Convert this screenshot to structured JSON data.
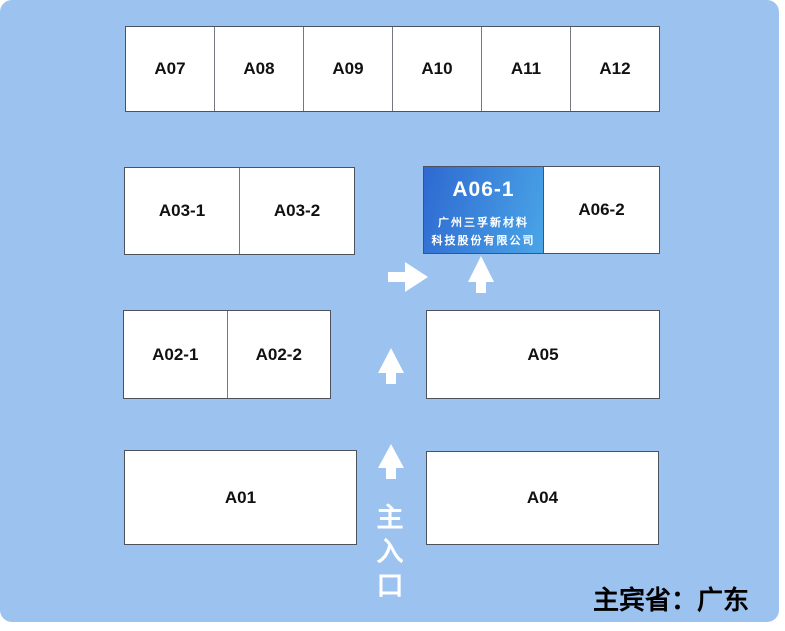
{
  "canvas": {
    "background_color": "#9CC2EF",
    "corner_radius_px": 12
  },
  "colors": {
    "booth_fill": "#FFFFFF",
    "booth_border": "#4D525C",
    "highlight_gradient_from": "#2E69D1",
    "highlight_gradient_to": "#4AA5E7",
    "label_text": "#111111",
    "arrow_and_entrance_text": "#FFFFFF",
    "footer_text": "#000000"
  },
  "booths": {
    "top_row": [
      "A07",
      "A08",
      "A09",
      "A10",
      "A11",
      "A12"
    ],
    "a03_row": [
      "A03-1",
      "A03-2"
    ],
    "a06_row": {
      "highlight": {
        "label": "A06-1",
        "company_line1": "广州三孚新材料",
        "company_line2": "科技股份有限公司"
      },
      "neighbor": "A06-2"
    },
    "a02_row": [
      "A02-1",
      "A02-2"
    ],
    "a05": "A05",
    "a01": "A01",
    "a04": "A04"
  },
  "arrows": [
    {
      "name": "right-arrow-to-a06-1",
      "direction": "right"
    },
    {
      "name": "up-arrow-below-a06-1",
      "direction": "up"
    },
    {
      "name": "up-arrow-mid-corridor",
      "direction": "up"
    },
    {
      "name": "up-arrow-entrance",
      "direction": "up"
    }
  ],
  "entrance": {
    "chars": [
      "主",
      "入",
      "口"
    ]
  },
  "footer": {
    "guest_province": "主宾省：广东"
  }
}
